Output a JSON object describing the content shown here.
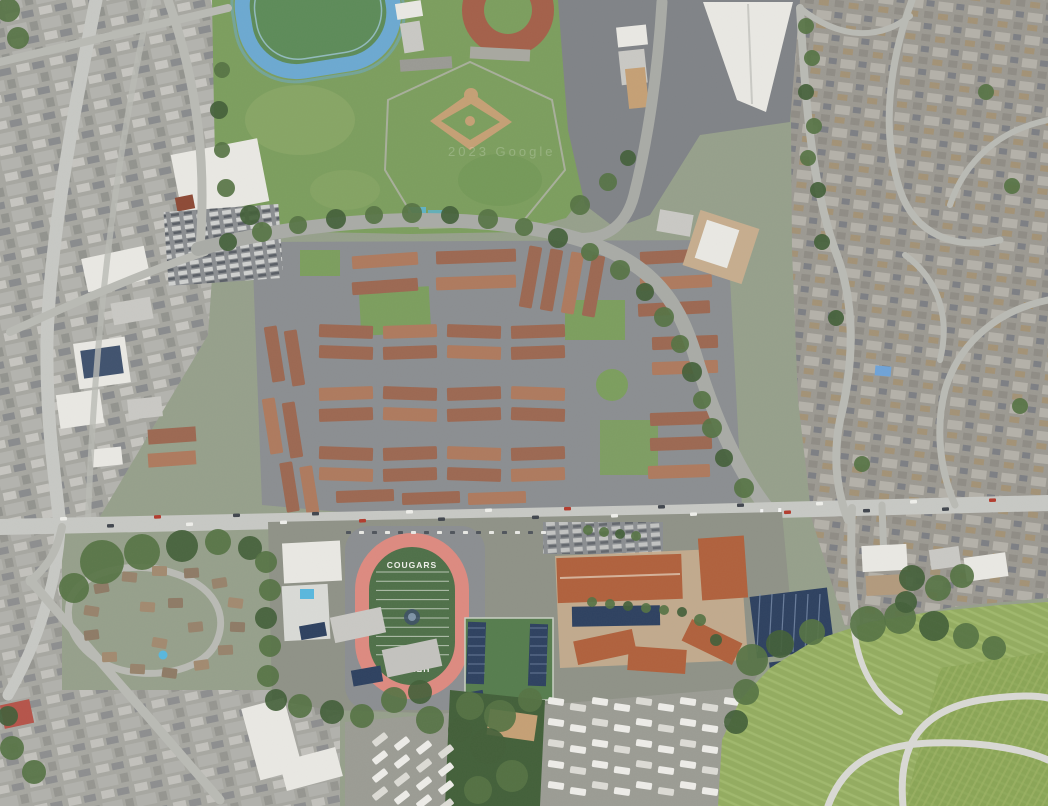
{
  "meta": {
    "type": "satellite-aerial-imagery",
    "description": "Aerial satellite view of a suburban district: school campus with red running track and football field, blue track and baseball diamonds to the north, large townhouse complex in the center, commercial strip on the west, dense residential streets on the east, mobile-home park to the south and a green cemetery field in the southeast."
  },
  "labels": {
    "field_home_text": "COUGARS",
    "field_away_text": "HELMS",
    "watermark": "2023 Google"
  },
  "palette": {
    "base": "#96a08b",
    "urbanBase": "#a7a7a1",
    "suburbBase": "#9c9992",
    "road": "#c7c8c4",
    "roadMinor": "#b9bab4",
    "roadMid": "#a9aba6",
    "roadBright": "#d9d9d4",
    "asphalt": "#8b8e91",
    "asphaltDark": "#808387",
    "grass": "#7c9e5e",
    "grassLight": "#94ad6e",
    "turf": "#4f7049",
    "turfBlue": "#5d8b59",
    "tree": "#567344",
    "treeDark": "#43603a",
    "dirt": "#c5a075",
    "dirtRed": "#a4604a",
    "terr": "#9c6852",
    "terr2": "#ae7a5e",
    "orangeRoof": "#b0613d",
    "whiteRoof": "#e9e8e3",
    "grayRoof": "#c9c8c4",
    "solar": "#2e4160",
    "trackRed": "#dd8a80",
    "trackBlue": "#6ca9d1",
    "trackBlueL": "#a9cfe8",
    "pool": "#59b7dd",
    "cemetery": "#93ac60",
    "vineyard": "#83a050",
    "plaza": "#c6ad8e",
    "carDark": "#41464e",
    "carWhite": "#eeeeea",
    "carRed": "#b23c2e",
    "wm": "#ffffff",
    "ridge": "#e6d5c2",
    "fence": "#b3b3aa"
  }
}
